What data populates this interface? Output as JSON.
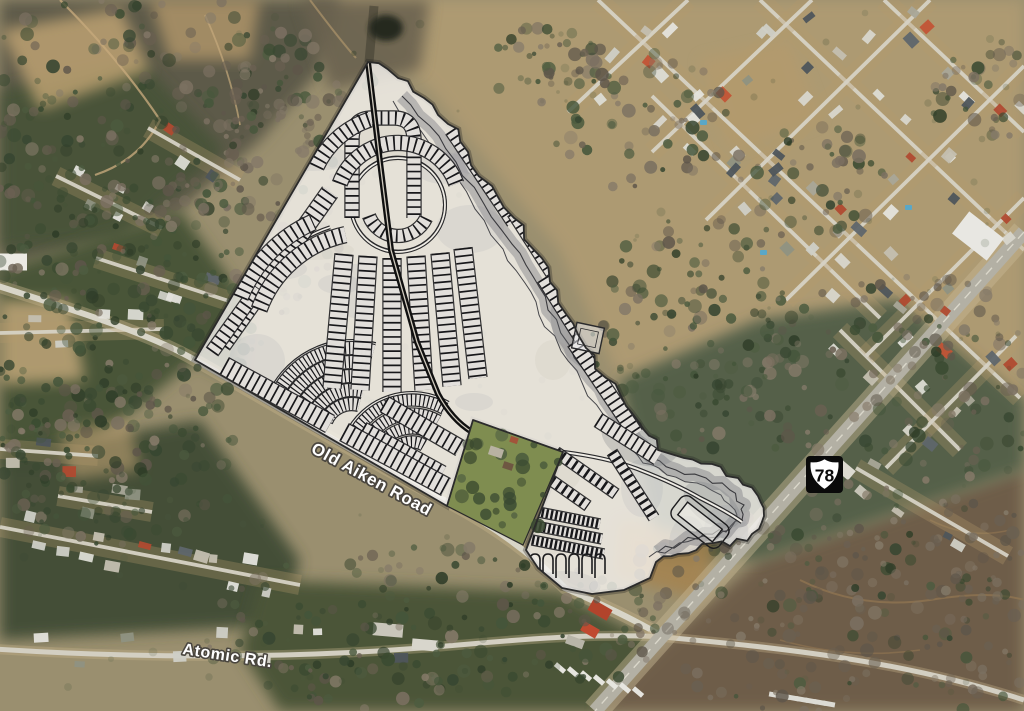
{
  "map": {
    "description": "Aerial satellite view with proposed subdivision site plan overlay",
    "labels": {
      "old_aiken_road": "Old Aiken Road",
      "atomic_rd": "Atomic Rd.",
      "route_shield_number": "78"
    },
    "colors": {
      "site_plan_fill": "#f6f4f0",
      "site_plan_linework": "#1c1c1e",
      "road_label_fill": "#ffffff",
      "road_label_halo": "#4a463f",
      "shield_background": "#0a0a0a",
      "shield_face": "#ffffff"
    }
  }
}
